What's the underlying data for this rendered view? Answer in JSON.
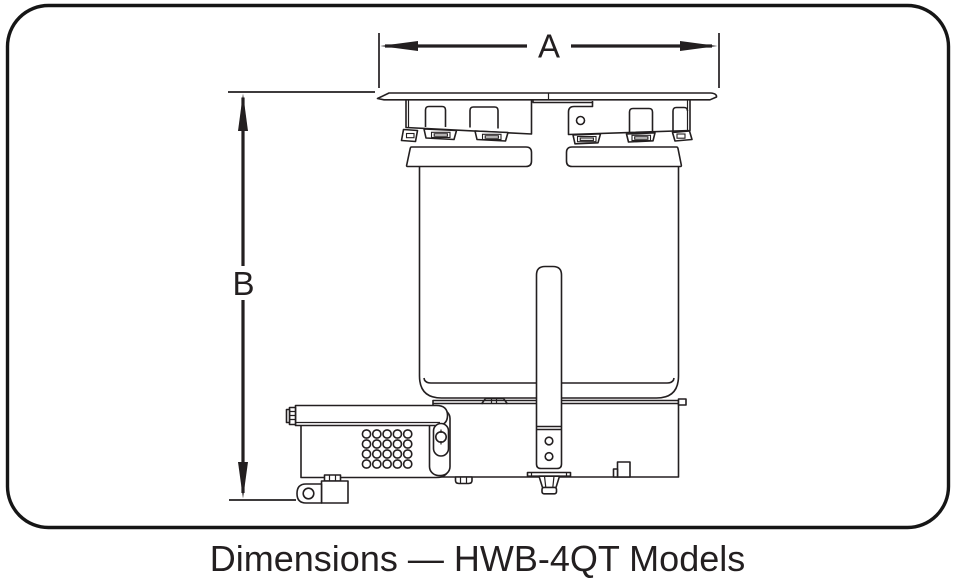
{
  "diagram": {
    "caption": "Dimensions — HWB-4QT Models",
    "dimension_labels": {
      "width": "A",
      "height": "B"
    },
    "colors": {
      "line": "#231f20",
      "border": "#161616",
      "background": "#ffffff"
    }
  }
}
